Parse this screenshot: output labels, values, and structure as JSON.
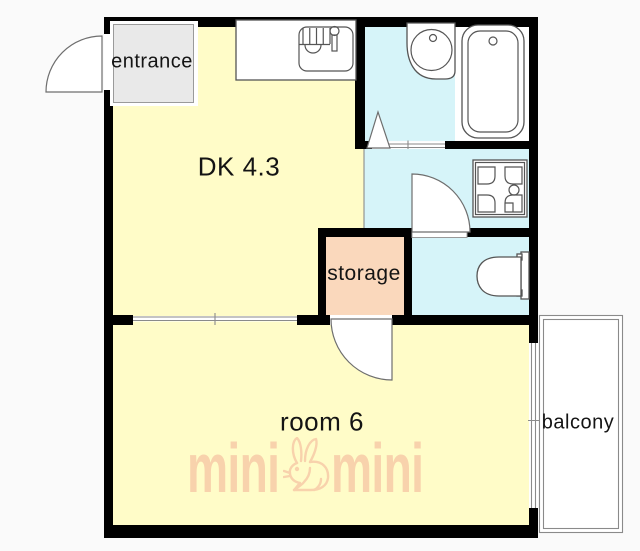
{
  "plan": {
    "rooms": {
      "entrance": {
        "label": "entrance"
      },
      "dk": {
        "label": "DK 4.3"
      },
      "storage": {
        "label": "storage"
      },
      "room": {
        "label": "room 6"
      },
      "balcony": {
        "label": "balcony"
      }
    },
    "watermark": {
      "left": "mini",
      "right": "mini",
      "icon": "rabbit-icon"
    },
    "fixtures": [
      "kitchen-sink",
      "wash-basin",
      "bathtub",
      "washing-machine-pan",
      "toilet",
      "entrance-door-swing",
      "bathroom-folding-door",
      "toilet-door-swing",
      "storage-door-swing",
      "sliding-door",
      "balcony-window"
    ],
    "colors": {
      "page_bg": "#fafafa",
      "room_fill": "#fffcc8",
      "wet_fill": "#d6f4f9",
      "storage_fill": "#fad8bc",
      "entrance_fill": "#e9e9e9",
      "balcony_fill": "#ffffff",
      "wall_color": "#000000",
      "line_color": "#555555",
      "watermark_color": "#f8d2ac"
    }
  }
}
